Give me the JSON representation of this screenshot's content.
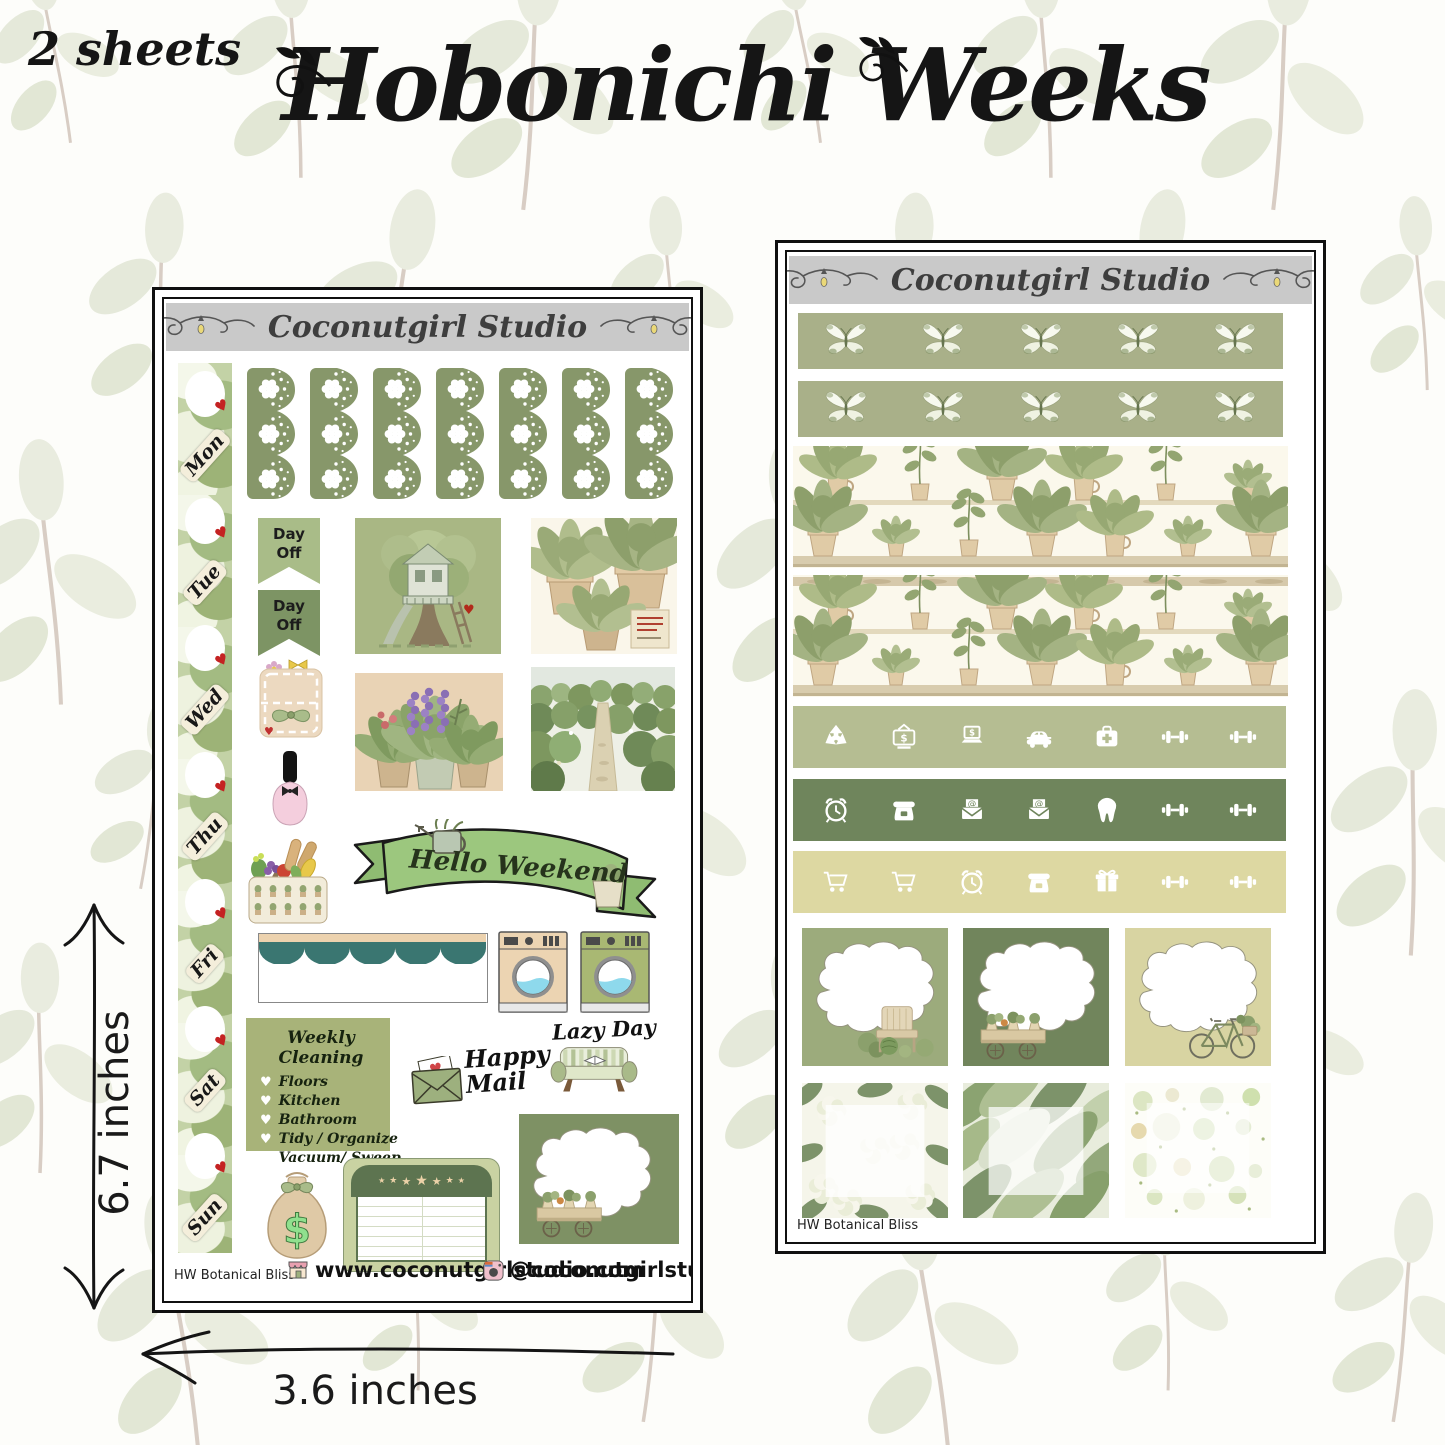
{
  "page": {
    "sheets_count_label": "2 sheets",
    "title": "Hobonichi Weeks",
    "height_label": "6.7 inches",
    "width_label": "3.6 inches"
  },
  "brand": {
    "name": "Coconutgirl Studio",
    "website": "www.coconutgirlstudio.com",
    "instagram": "@coconutgirlstudio",
    "kit_name": "HW Botanical Bliss"
  },
  "left_sheet": {
    "days": [
      "Mon",
      "Tue",
      "Wed",
      "Thu",
      "Fri",
      "Sat",
      "Sun"
    ],
    "lace_sticker_count": 7,
    "day_off_flags": [
      {
        "label": "Day\nOff",
        "color": "#a9bc88"
      },
      {
        "label": "Day\nOff",
        "color": "#7d9464"
      }
    ],
    "hello_weekend_label": "Hello Weekend",
    "weekly_cleaning": {
      "title": "Weekly Cleaning",
      "items": [
        "Floors",
        "Kitchen",
        "Bathroom",
        "Tidy / Organize",
        "Vacuum/ Sweep"
      ]
    },
    "happy_mail_label": "Happy\nMail",
    "lazy_day_label": "Lazy Day",
    "illustrations": [
      "treehouse",
      "potted-plants",
      "lavender-pots",
      "garden-path",
      "grocery-basket",
      "nail-polish",
      "sticker-book",
      "washing-machine-beige",
      "washing-machine-green",
      "money-bag",
      "star-tracker",
      "garden-cart-label"
    ]
  },
  "right_sheet": {
    "butterfly_strips": 2,
    "butterflies_per_strip": 5,
    "plant_shelf_strips": 2,
    "icon_strips": [
      {
        "color": "#b5bd92",
        "icons": [
          "recycle",
          "tv-money",
          "laptop-money",
          "car",
          "first-aid",
          "dumbbell",
          "dumbbell"
        ]
      },
      {
        "color": "#6f855c",
        "icons": [
          "alarm-clock",
          "telephone",
          "email",
          "email",
          "tooth",
          "dumbbell",
          "dumbbell"
        ]
      },
      {
        "color": "#ddd8a2",
        "icons": [
          "shopping-cart",
          "shopping-cart",
          "alarm-clock",
          "telephone",
          "gift",
          "dumbbell",
          "dumbbell"
        ]
      }
    ],
    "label_boxes": [
      {
        "color": "#9cab7c",
        "image": "garden-bench"
      },
      {
        "color": "#71855c",
        "image": "garden-cart"
      },
      {
        "color": "#d8d4a2",
        "image": "bicycle"
      }
    ],
    "pattern_boxes": [
      "hydrangea",
      "leaves",
      "dots"
    ]
  },
  "colors": {
    "header_band": "#c9c9c9",
    "lace_green": "#87976a",
    "butterfly_strip": "#a9b089",
    "dark_green": "#6f855c",
    "light_sage": "#b5bd92",
    "khaki": "#ddd8a2",
    "beige": "#e9d3b5",
    "red_accent": "#c42222",
    "banner_green": "#9cc77e"
  }
}
